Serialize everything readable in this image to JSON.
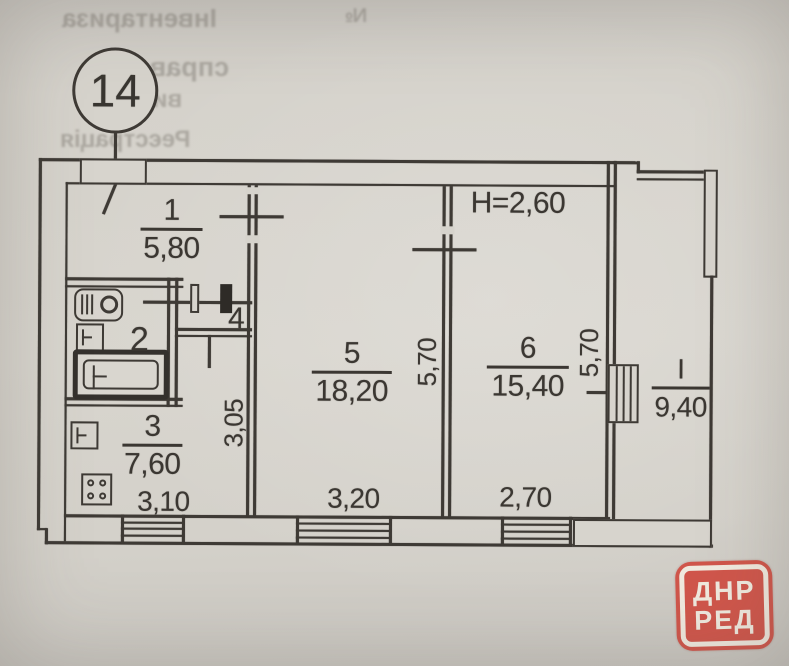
{
  "unit_badge": {
    "number": "14"
  },
  "plan": {
    "ceiling_height_label": "H=2,60",
    "rooms": [
      {
        "number": "1",
        "area": "5,80"
      },
      {
        "number": "2",
        "area": ""
      },
      {
        "number": "3",
        "area": "7,60"
      },
      {
        "number": "4",
        "area": ""
      },
      {
        "number": "5",
        "area": "18,20"
      },
      {
        "number": "6",
        "area": "15,40"
      }
    ],
    "balcony": {
      "number": "I",
      "area": "9,40"
    },
    "dimensions": {
      "kitchen_width": "3,10",
      "kitchen_depth": "3,05",
      "room5_width": "3,20",
      "room5_depth": "5,70",
      "room6_width": "2,70",
      "room6_depth": "5,70"
    }
  },
  "bleed_through": {
    "fragment1": "Інвентариза",
    "fragment2": "справа",
    "fragment3": "видано",
    "fragment4": "Реєстрація",
    "fragment5": "№"
  },
  "stamp": {
    "line1": "ДНР",
    "line2": "РЕД",
    "fill_color": "#d0564b",
    "text_color": "#f0eadf"
  }
}
